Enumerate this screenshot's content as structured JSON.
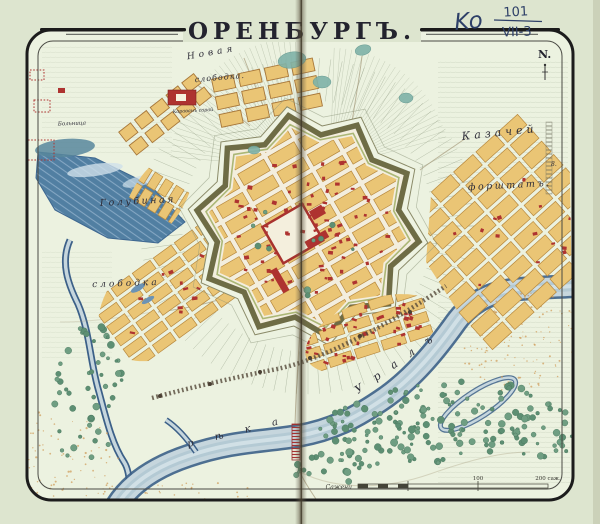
{
  "annotation": {
    "prefix": "Ko",
    "numerator": "101",
    "denominator": "VII-3"
  },
  "title": "ОРЕНБУРГЪ.",
  "compass_label": "N.",
  "labels": {
    "novaya": "Новая",
    "slobodka_top": "слободка.",
    "karavan": "Караванъ сарай",
    "bolnitsa": "Больница",
    "golubinaya": "Голубиная",
    "slobodka_left": "слободка",
    "kazachey": "Казачей",
    "forshtat": "форштатъ.",
    "river_word1": "рѣка",
    "river_word2": "Уралъ",
    "ref_number": "8."
  },
  "scalebar": {
    "unit_label": "Сажени",
    "tick_100": "100",
    "tick_200": "200 саж."
  },
  "colors": {
    "paper": "#dde5cf",
    "ground": "#ecf2e0",
    "water_dark": "#49799f",
    "river_light": "#c6d6dd",
    "block_yellow": "#eac575",
    "building_red": "#ae3330",
    "rampart_olive": "#6e6c45",
    "tree_green": "#6f9e82",
    "sand": "#cf9a55",
    "ink": "#23232e",
    "pen_ink": "#2e4068"
  }
}
